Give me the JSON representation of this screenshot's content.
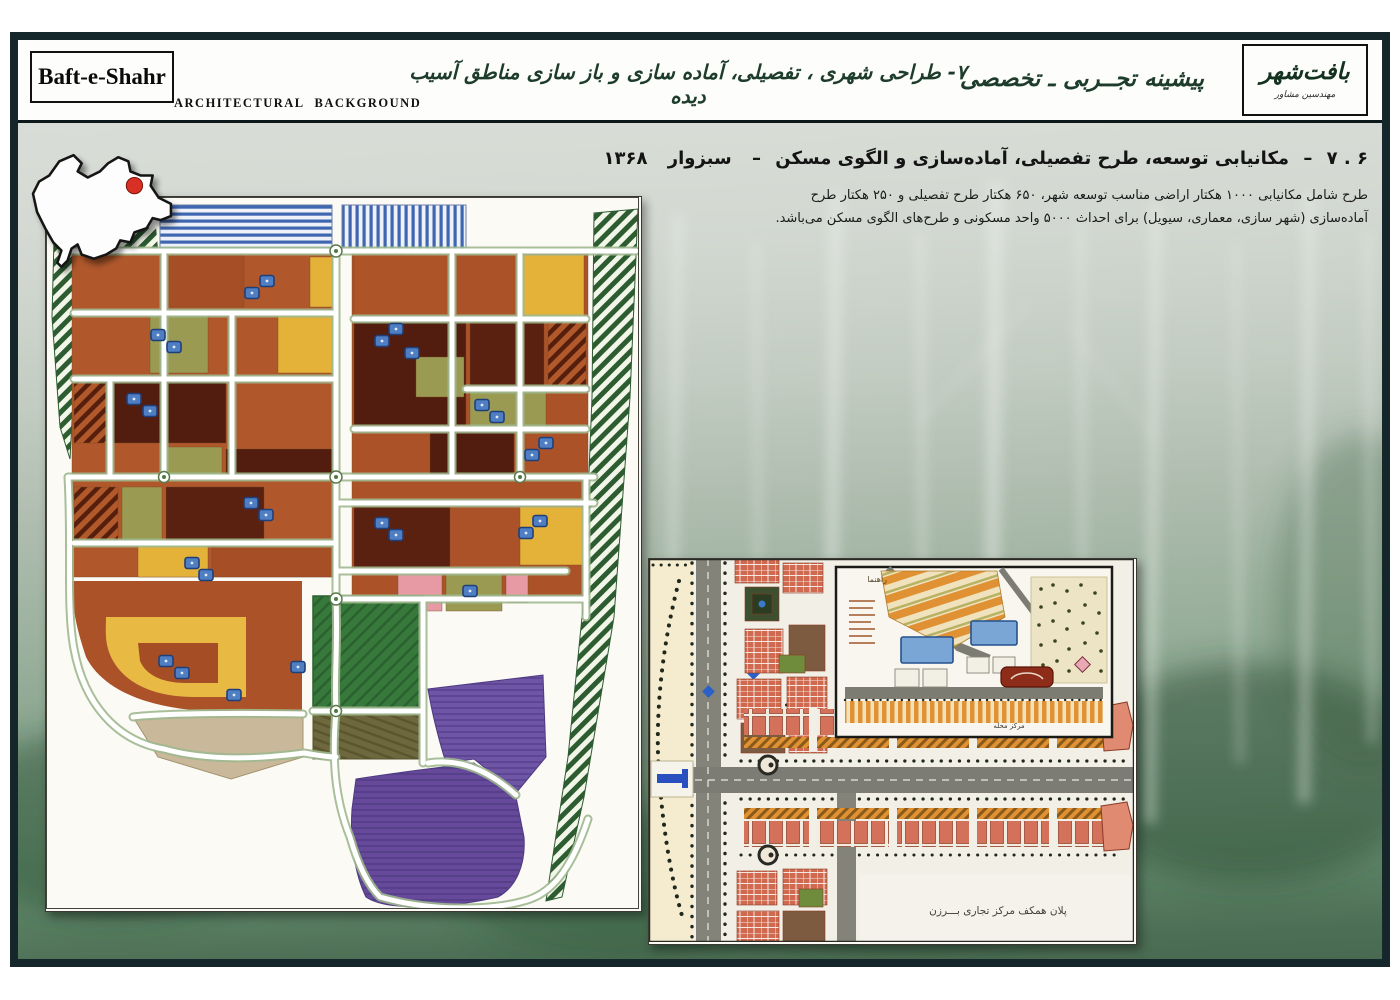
{
  "window": {
    "width": 1400,
    "height": 1000,
    "kind": "presentation-slide"
  },
  "header": {
    "logo_text": "Baft-e-Shahr",
    "logo_subtitle": "ARCHITECTURAL  BACKGROUND",
    "center_title": "۷- طراحی شهری ، تفصیلی، آماده سازی و باز سازی مناطق آسیب دیده",
    "right_subtitle": "پیشینه تجــربی ـ تخصصی",
    "right_logo_main": "بافت‌شهر",
    "right_logo_sub": "مهندسین مشاور",
    "accent_color": "#1d3c2b",
    "frame_color": "#15272b"
  },
  "section": {
    "number": "۶ . ۷",
    "dash": "–",
    "title": "مکانیابی توسعه، طرح تفصیلی، آماده‌سازی و الگوی مسکن",
    "location": "سبزوار",
    "year": "۱۳۶۸",
    "body": "طرح شامل مکانیابی ۱۰۰۰ هکتار اراضی مناسب توسعه شهر،  ۶۵۰ هکتار طرح تفصیلی و ۲۵۰ هکتار طرح آماده‌سازی (شهر سازی، معماری، سیویل) برای احداث ۵۰۰۰ واحد مسکونی و طرح‌های الگوی مسکن می‌باشد."
  },
  "maps": {
    "iran_locator": {
      "name": "iran-location-map",
      "marker_color": "#d93025"
    },
    "master_plan": {
      "name": "sabzevar-development-master-plan"
    },
    "detail_caption": "پلان همکف مرکز تجاری بـــرزن",
    "inset_legend_title": "راهنما",
    "inset_caption": "مرکز محله"
  },
  "palette": {
    "bg_top": "#d9ddd7",
    "bg_bottom": "#486a50",
    "plan_orange": "#b0582c",
    "plan_maroon": "#521d0e",
    "plan_yellow": "#e5b239",
    "plan_olive": "#9a9a52",
    "plan_blue": "#4f7fc2",
    "plan_purple": "#67499c",
    "plan_green_field": "#37793a",
    "plan_khaki": "#6e683f",
    "plan_pink": "#e79aa4",
    "plan_tan": "#c9b89a",
    "plan_belt_green": "#2d5c31",
    "detail_salmon": "#cf6a50",
    "detail_orange": "#e09133",
    "detail_road": "#7c7c74"
  }
}
